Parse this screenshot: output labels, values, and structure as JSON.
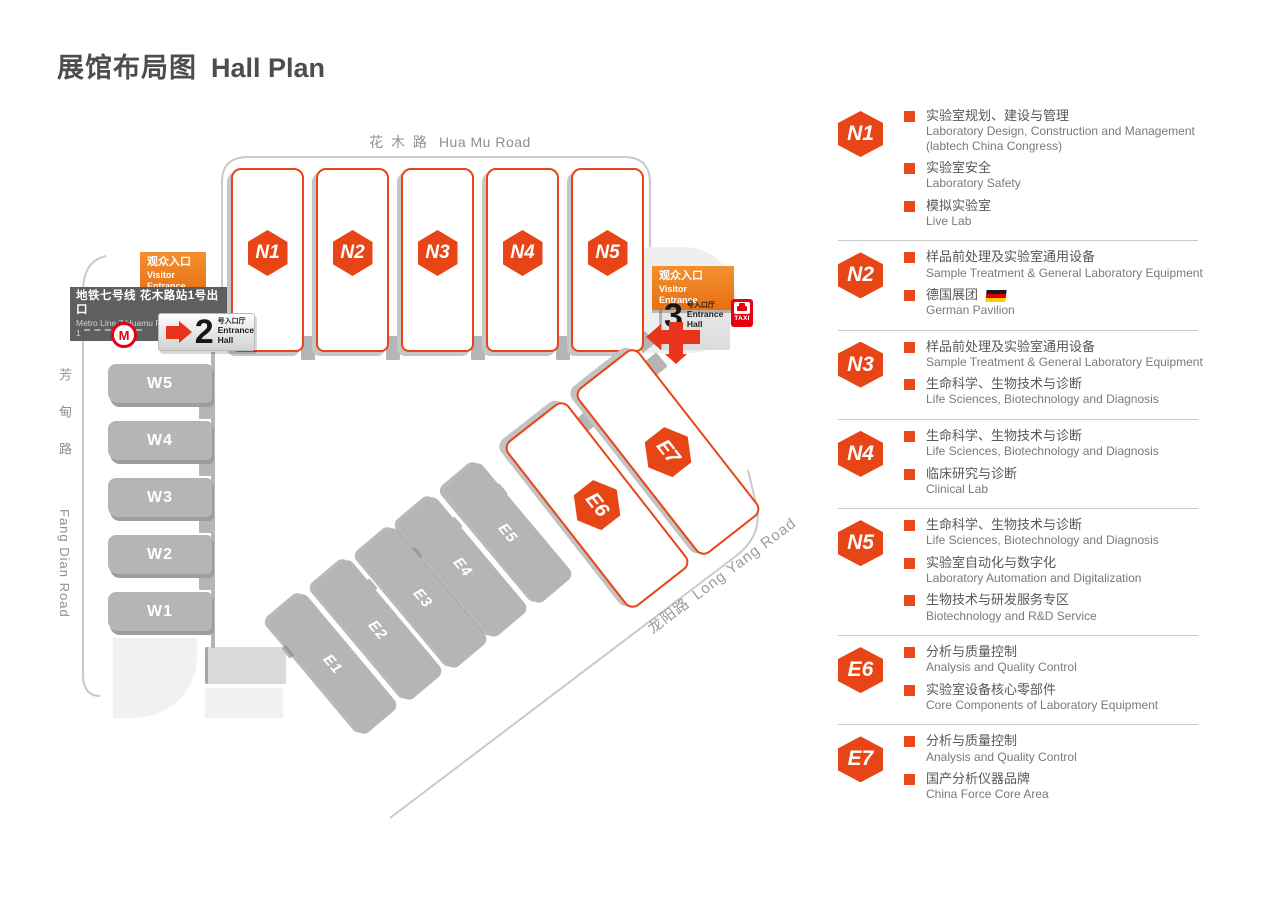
{
  "page": {
    "title_zh": "展馆布局图",
    "title_en": "Hall Plan"
  },
  "colors": {
    "accent": "#e84517",
    "entrance_orange": "#ed7b1e",
    "signal_red": "#e60012",
    "hall_gray": "#b4b5b6",
    "road_gray": "#c9caca",
    "text_dark": "#595757",
    "text_gray": "#7b7979"
  },
  "map": {
    "roads": {
      "top": {
        "zh": "花 木 路",
        "en": "Hua Mu Road"
      },
      "left": {
        "zh": "芳甸路",
        "en": "Fang Dian Road"
      },
      "bottom": {
        "zh": "龙阳路",
        "en": "Long Yang Road"
      }
    },
    "halls": {
      "north": [
        "N1",
        "N2",
        "N3",
        "N4",
        "N5"
      ],
      "west": [
        "W5",
        "W4",
        "W3",
        "W2",
        "W1"
      ],
      "east": [
        "E1",
        "E2",
        "E3",
        "E4",
        "E5"
      ],
      "east_feature": [
        "E6",
        "E7"
      ]
    },
    "entrance_west": {
      "visitor_zh": "观众入口",
      "visitor_en": "Visitor Entrance",
      "metro_zh": "地铁七号线 花木路站1号出口",
      "metro_en": "Metro Line 7  Huamu Rd. Station Exit 1",
      "number": "2",
      "number_suffix_zh": "号入口厅",
      "hall_en_line1": "Entrance",
      "hall_en_line2": "Hall",
      "metro_logo_letter": "M"
    },
    "entrance_east": {
      "visitor_zh": "观众入口",
      "visitor_en": "Visitor Entrance",
      "number": "3",
      "number_suffix_zh": "号入口厅",
      "hall_en_line1": "Entrance",
      "hall_en_line2": "Hall",
      "taxi_label": "TAXI"
    }
  },
  "legend": {
    "sections": [
      {
        "id": "N1",
        "items": [
          {
            "zh": "实验室规划、建设与管理",
            "en": "Laboratory Design, Construction and Management (labtech China Congress)"
          },
          {
            "zh": "实验室安全",
            "en": "Laboratory Safety"
          },
          {
            "zh": "模拟实验室",
            "en": "Live Lab"
          }
        ]
      },
      {
        "id": "N2",
        "items": [
          {
            "zh": "样品前处理及实验室通用设备",
            "en": "Sample Treatment & General Laboratory Equipment"
          },
          {
            "zh": "德国展团",
            "en": "German Pavilion",
            "flag": true
          }
        ]
      },
      {
        "id": "N3",
        "items": [
          {
            "zh": "样品前处理及实验室通用设备",
            "en": "Sample Treatment & General Laboratory Equipment"
          },
          {
            "zh": "生命科学、生物技术与诊断",
            "en": "Life Sciences, Biotechnology and Diagnosis"
          }
        ]
      },
      {
        "id": "N4",
        "items": [
          {
            "zh": "生命科学、生物技术与诊断",
            "en": "Life Sciences, Biotechnology and Diagnosis"
          },
          {
            "zh": "临床研究与诊断",
            "en": "Clinical Lab"
          }
        ]
      },
      {
        "id": "N5",
        "items": [
          {
            "zh": "生命科学、生物技术与诊断",
            "en": "Life Sciences, Biotechnology and Diagnosis"
          },
          {
            "zh": "实验室自动化与数字化",
            "en": "Laboratory Automation and Digitalization"
          },
          {
            "zh": "生物技术与研发服务专区",
            "en": "Biotechnology and R&D Service"
          }
        ]
      },
      {
        "id": "E6",
        "items": [
          {
            "zh": "分析与质量控制",
            "en": "Analysis and Quality Control"
          },
          {
            "zh": "实验室设备核心零部件",
            "en": "Core Components of Laboratory Equipment"
          }
        ]
      },
      {
        "id": "E7",
        "items": [
          {
            "zh": "分析与质量控制",
            "en": "Analysis and Quality Control"
          },
          {
            "zh": "国产分析仪器品牌",
            "en": "China Force Core Area"
          }
        ]
      }
    ]
  }
}
